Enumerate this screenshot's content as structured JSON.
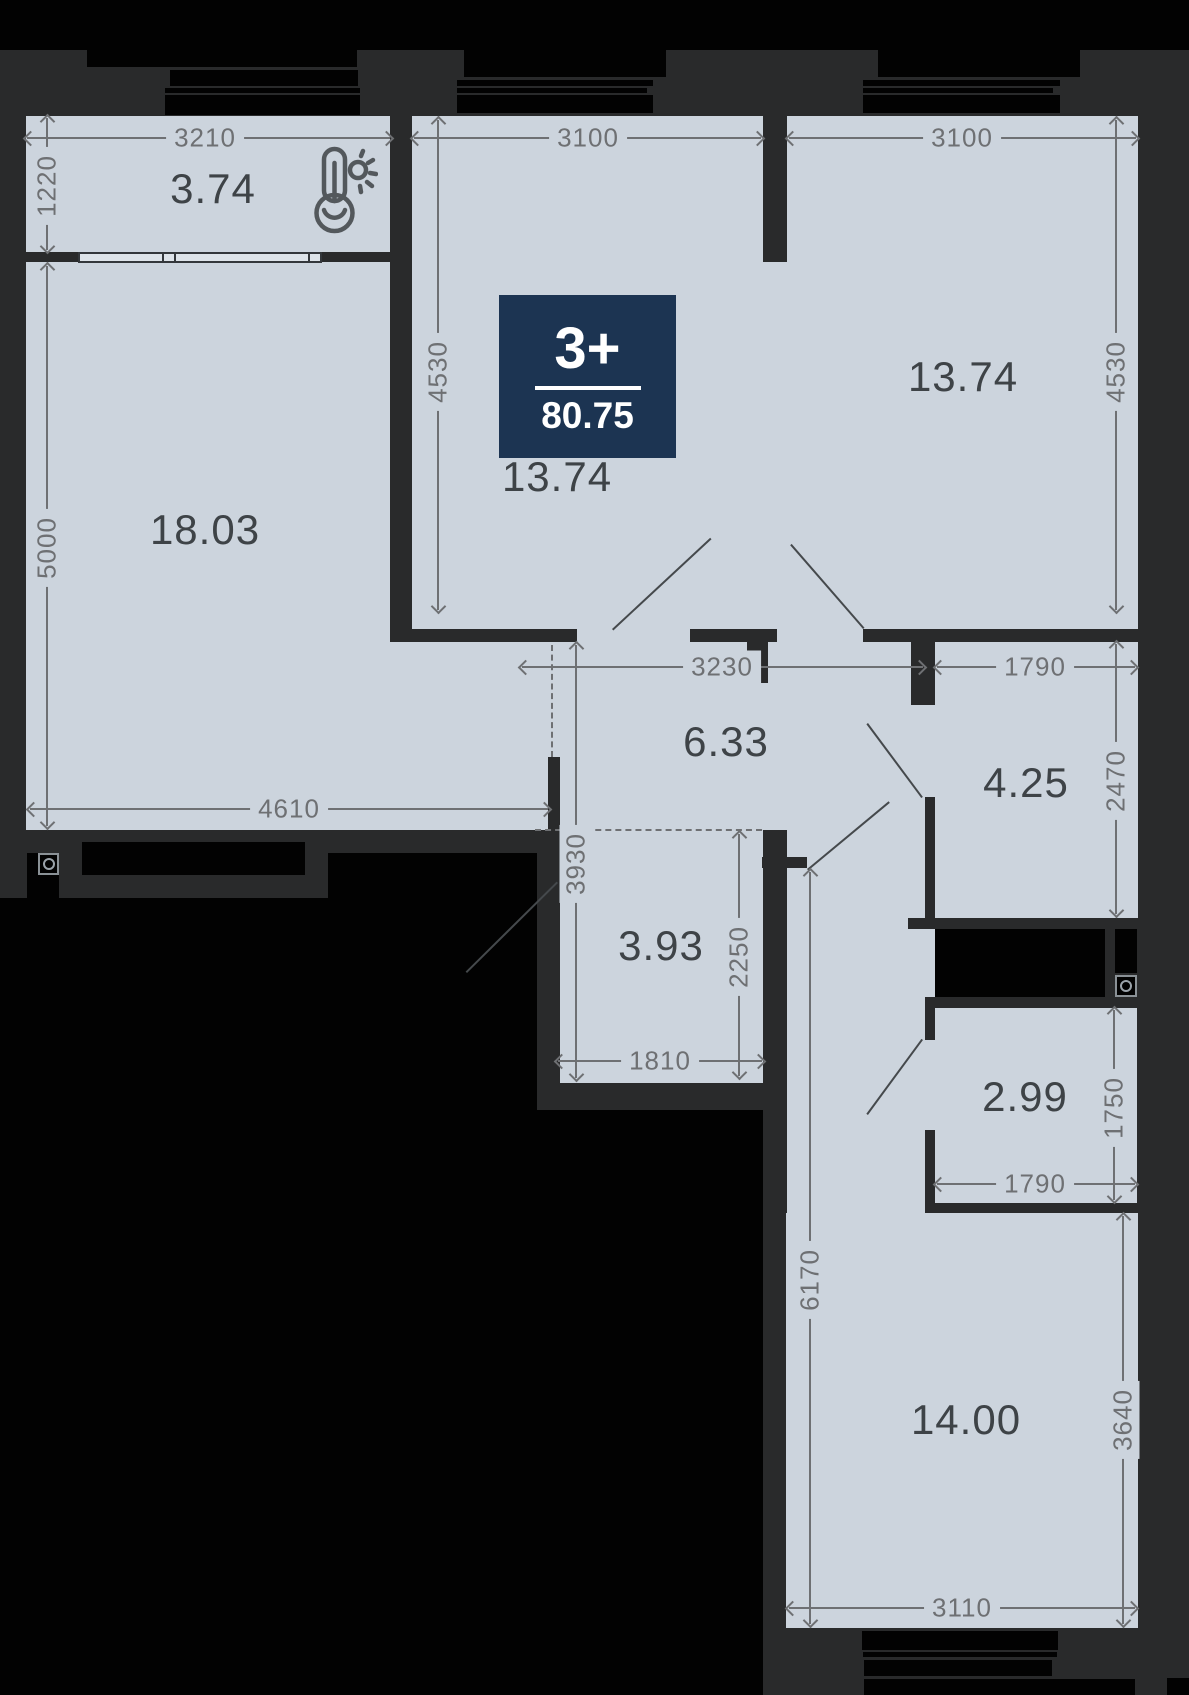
{
  "plan": {
    "badge": {
      "rooms_label": "3+",
      "total_area": "80.75"
    },
    "rooms": [
      {
        "id": "balcony",
        "area": "3.74"
      },
      {
        "id": "living",
        "area": "18.03"
      },
      {
        "id": "bedroom-middle",
        "area": "13.74"
      },
      {
        "id": "bedroom-right",
        "area": "13.74"
      },
      {
        "id": "hallway",
        "area": "6.33"
      },
      {
        "id": "bathroom",
        "area": "4.25"
      },
      {
        "id": "wc",
        "area": "3.93"
      },
      {
        "id": "storage",
        "area": "2.99"
      },
      {
        "id": "kitchen-living",
        "area": "14.00"
      }
    ],
    "dimensions_mm": {
      "d3210": "3210",
      "d1220": "1220",
      "d3100_mid": "3100",
      "d4530_mid": "4530",
      "d3100_right": "3100",
      "d4530_right": "4530",
      "d5000": "5000",
      "d4610": "4610",
      "d3230": "3230",
      "d1790_top": "1790",
      "d2470": "2470",
      "d3930": "3930",
      "d2250": "2250",
      "d1810": "1810",
      "d1750": "1750",
      "d1790_bottom": "1790",
      "d6170": "6170",
      "d3640": "3640",
      "d3110": "3110"
    },
    "icons": [
      "thermometer-sun-icon",
      "washing-machine-icon",
      "cooktop-icon"
    ],
    "colors": {
      "room_fill": "#ccd4dd",
      "wall": "#292a2b",
      "background": "#000000",
      "badge_bg": "#1c3452",
      "dimension_text": "#6e7073",
      "area_text": "#3e4347"
    }
  }
}
